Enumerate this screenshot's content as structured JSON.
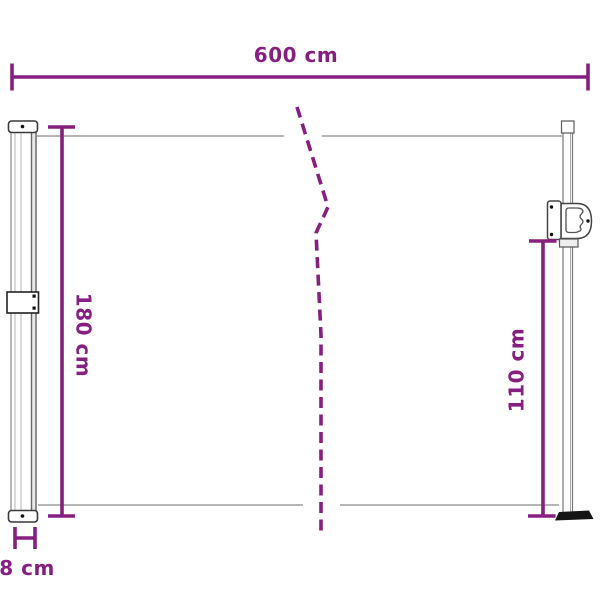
{
  "diagram": {
    "kind": "product-dimension-diagram",
    "colors": {
      "accent": "#861F80",
      "outline_gray": "#8A8A8A",
      "structure_gray": "#555555",
      "background": "#FFFFFF"
    },
    "measurements": {
      "width": {
        "label": "600 cm",
        "value": 600,
        "unit": "cm"
      },
      "height_total": {
        "label": "180 cm",
        "value": 180,
        "unit": "cm"
      },
      "height_front": {
        "label": "110 cm",
        "value": 110,
        "unit": "cm"
      },
      "depth": {
        "label": "8 cm",
        "value": 8,
        "unit": "cm"
      }
    }
  }
}
